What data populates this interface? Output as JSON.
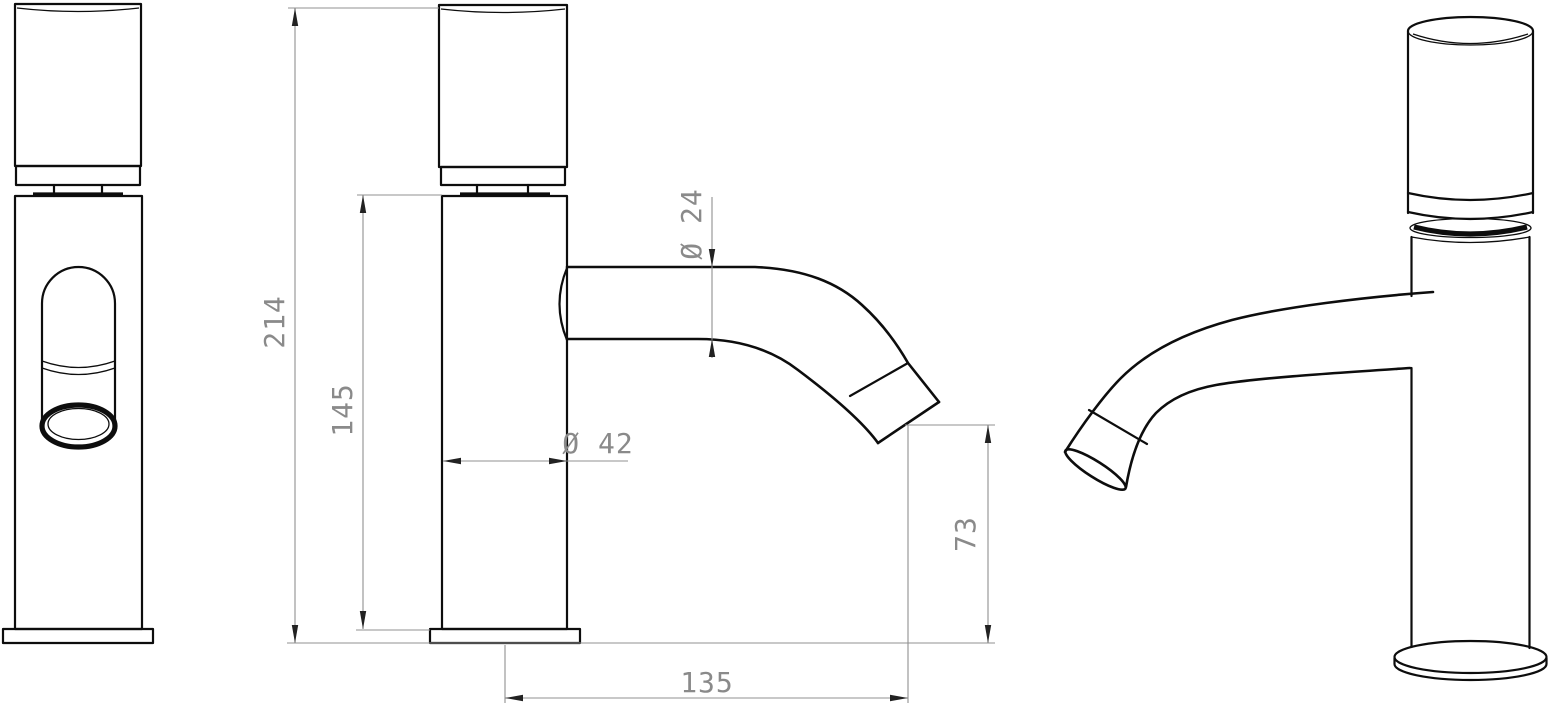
{
  "drawing": {
    "type": "technical-drawing",
    "subject": "single-lever basin faucet, three views"
  },
  "colors": {
    "line": "#0d0d0d",
    "dimension_line": "#909090",
    "dimension_text": "#8a8a8a",
    "background": "#ffffff"
  },
  "dimensions": {
    "total_height": "214",
    "body_height": "145",
    "spout_diameter": "Ø 24",
    "body_diameter": "Ø 42",
    "outlet_height": "73",
    "spout_reach": "135"
  }
}
